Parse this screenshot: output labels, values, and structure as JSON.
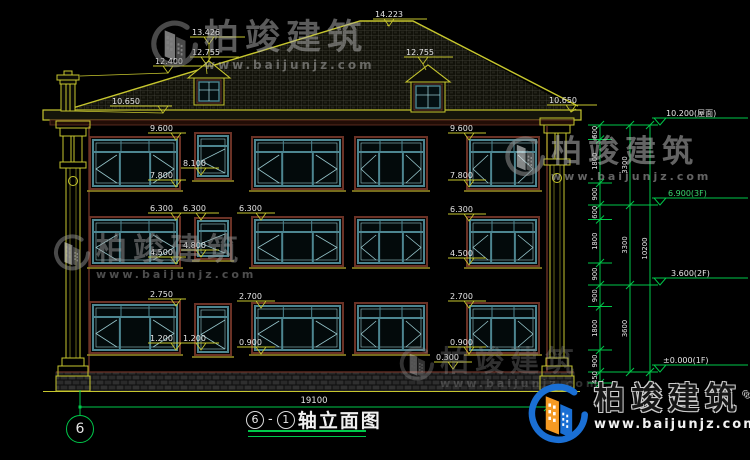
{
  "brand": {
    "name": "柏竣建筑",
    "reg": "®",
    "url": "www.baijunjz.com"
  },
  "title_block": {
    "axis_from": "6",
    "separator": "-",
    "axis_to": "1",
    "title": "轴立面图",
    "total_width": "19100"
  },
  "axis_bubble": "6",
  "levels_right": [
    {
      "label": "10.200(屋面)",
      "tone": "white"
    },
    {
      "label": "6.900(3F)",
      "tone": "green"
    },
    {
      "label": "3.600(2F)",
      "tone": "white"
    },
    {
      "label": "±0.000(1F)",
      "tone": "white"
    }
  ],
  "dim_chain": {
    "segments": [
      "600",
      "1800",
      "900",
      "600",
      "1800",
      "900",
      "900",
      "1800",
      "900",
      "450"
    ],
    "groups": [
      "3300",
      "3300",
      "3600"
    ],
    "total": "10200"
  },
  "elevation_markers": [
    {
      "t": "12.400",
      "x": 155,
      "y": 64,
      "g": 168,
      "w": 60,
      "l": [
        80,
        76
      ]
    },
    {
      "t": "10.650",
      "x": 112,
      "y": 104,
      "g": 163,
      "w": 62,
      "l": [
        70,
        111
      ]
    },
    {
      "t": "13.426",
      "x": 192,
      "y": 35,
      "g": 209,
      "w": 55,
      "l": [
        209,
        62
      ]
    },
    {
      "t": "12.755",
      "x": 192,
      "y": 55,
      "g": 206,
      "w": 49,
      "l": [
        207,
        74
      ]
    },
    {
      "t": "14.223",
      "x": 375,
      "y": 17,
      "g": 389,
      "w": 54,
      "l": [
        387,
        25
      ]
    },
    {
      "t": "12.755",
      "x": 406,
      "y": 55,
      "g": 423,
      "w": 49,
      "l": [
        426,
        70
      ]
    },
    {
      "t": "10.650",
      "x": 549,
      "y": 103,
      "g": 571,
      "w": 50,
      "l": [
        576,
        109
      ]
    },
    {
      "t": "9.600",
      "x": 150,
      "y": 131,
      "g": 176
    },
    {
      "t": "7.800",
      "x": 150,
      "y": 178,
      "g": 176
    },
    {
      "t": "8.100",
      "x": 183,
      "y": 166,
      "g": 201
    },
    {
      "t": "9.600",
      "x": 450,
      "y": 131,
      "g": 469
    },
    {
      "t": "7.800",
      "x": 450,
      "y": 178,
      "g": 469
    },
    {
      "t": "6.300",
      "x": 150,
      "y": 211,
      "g": 176
    },
    {
      "t": "6.300",
      "x": 183,
      "y": 211,
      "g": 201
    },
    {
      "t": "6.300",
      "x": 239,
      "y": 211,
      "g": 261
    },
    {
      "t": "6.300",
      "x": 450,
      "y": 212,
      "g": 469
    },
    {
      "t": "4.500",
      "x": 150,
      "y": 255,
      "g": 176
    },
    {
      "t": "4.800",
      "x": 183,
      "y": 248,
      "g": 201
    },
    {
      "t": "4.500",
      "x": 450,
      "y": 256,
      "g": 469
    },
    {
      "t": "2.750",
      "x": 150,
      "y": 297,
      "g": 176
    },
    {
      "t": "2.700",
      "x": 239,
      "y": 299,
      "g": 261
    },
    {
      "t": "2.700",
      "x": 450,
      "y": 299,
      "g": 469
    },
    {
      "t": "1.200",
      "x": 150,
      "y": 341,
      "g": 176
    },
    {
      "t": "1.200",
      "x": 183,
      "y": 341,
      "g": 201
    },
    {
      "t": "0.900",
      "x": 239,
      "y": 345,
      "g": 261
    },
    {
      "t": "0.900",
      "x": 450,
      "y": 345,
      "g": 469
    },
    {
      "t": "0.300",
      "x": 436,
      "y": 360,
      "g": 453
    }
  ],
  "colors": {
    "bg": "#000000",
    "yellow": "#c6c62e",
    "green": "#00c84a",
    "teal": "#4d8691",
    "teal_light": "#96c6cc",
    "maroon": "#6b3226",
    "text": "#e6e6e6",
    "sill": "#9d8f26",
    "logo_blue": "#1a6fd4",
    "logo_orange": "#f59a23",
    "level_green_text": "#3bd56f"
  }
}
